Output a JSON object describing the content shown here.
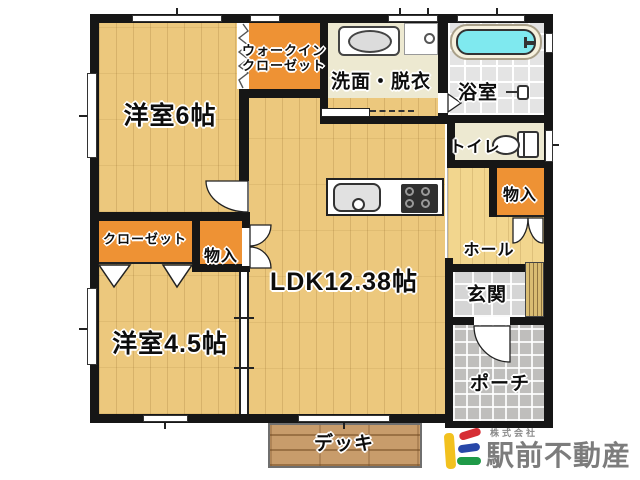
{
  "plan": {
    "rooms": {
      "yoshitsu6": "洋室6帖",
      "wic_line1": "ウォークイン",
      "wic_line2": "クローゼット",
      "senmen": "洗面・脱衣",
      "yokushitsu": "浴室",
      "toilet": "トイレ",
      "monoire_hall": "物入",
      "monoire_center": "物入",
      "closet": "クローゼット",
      "ldk": "LDK12.38帖",
      "hall": "ホール",
      "genkan": "玄関",
      "yoshitsu45": "洋室4.5帖",
      "porch": "ポーチ",
      "deck": "デッキ"
    },
    "colors": {
      "wood": "#ecc87d",
      "wood_hall": "#f2d68e",
      "orange": "#ee9234",
      "cream": "#ede9d1",
      "bath_tile": "#e4e4e4",
      "genkan_tile": "#d5d5d5",
      "porch": "#bfbebc",
      "deck": "#c89c6b",
      "tub": "#7fe9ef",
      "wall": "#161616"
    }
  },
  "branding": {
    "company_prefix": "株式会社",
    "company_name": "駅前不動産",
    "logo_colors": {
      "yellow": "#f2c11e",
      "red": "#d62e35",
      "blue": "#2847a8",
      "green": "#1f9a48"
    }
  }
}
